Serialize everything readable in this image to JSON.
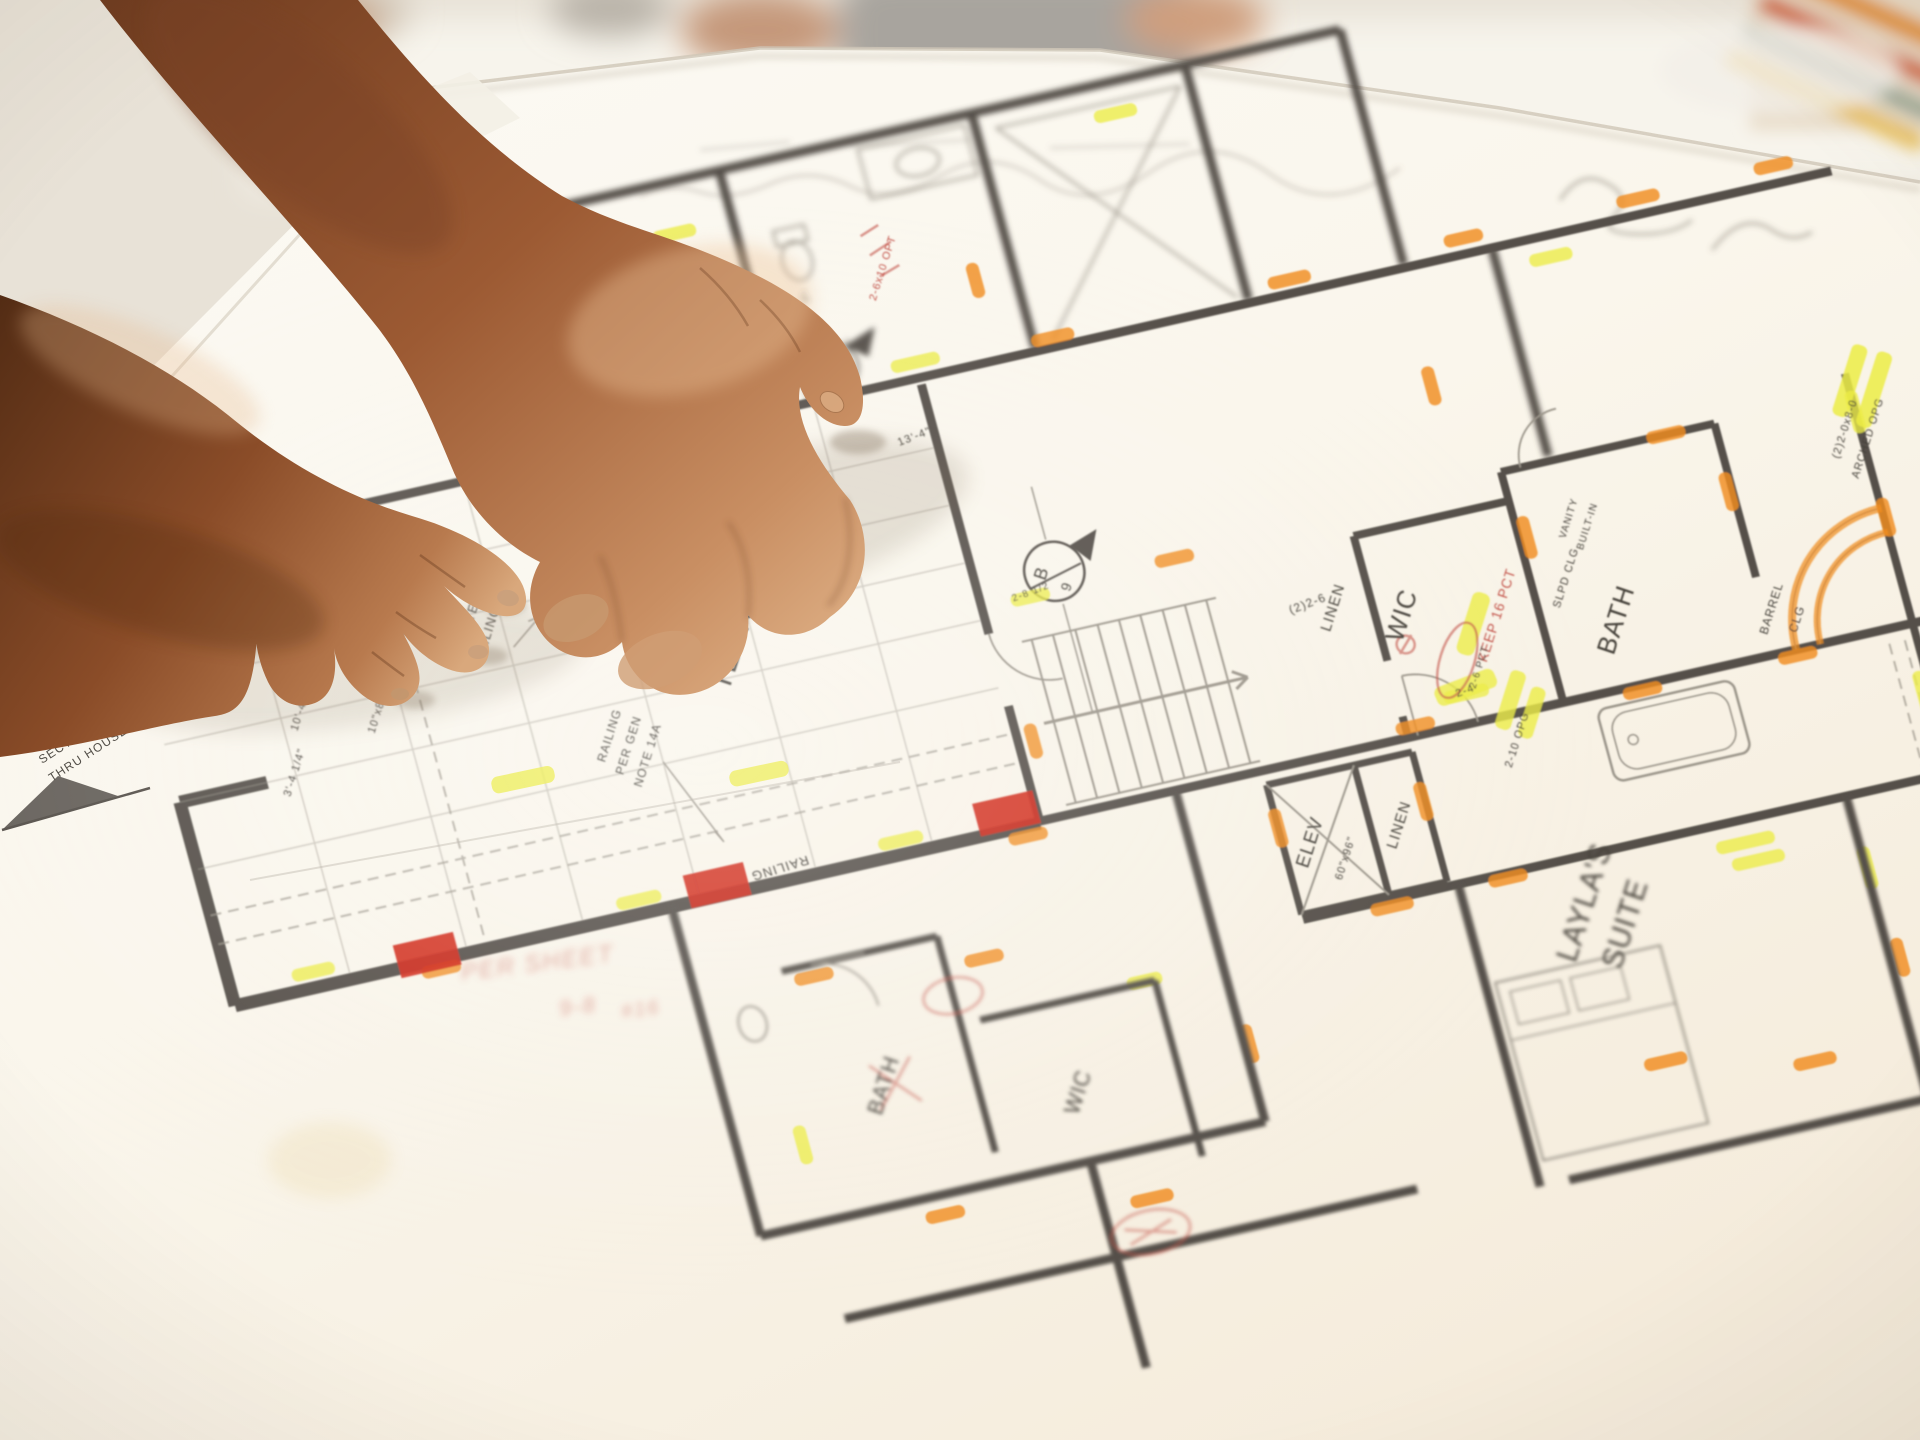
{
  "scene": {
    "description": "Two hands of a builder pointing at an architectural floor-plan blueprint laid on a table, with highlighter and red pencil markups; blurred people in background"
  },
  "colors": {
    "background": "#e8e2d7",
    "table": "#f1ebe1",
    "paper": "#fbf7ef",
    "wall": "#55504a",
    "thin_line": "#9b958a",
    "highlight_orange": "#f08c1e",
    "highlight_yellow": "#ecec45",
    "red_mark": "#d02818",
    "red_pencil": "#c4544a",
    "skin_dark": "#5f3318",
    "skin_mid": "#a5643a",
    "skin_light": "#dcab80",
    "shirt_gray": "#a8a49e",
    "stripe_orange": "#e0912f",
    "stripe_rust": "#cf5a25"
  },
  "plan": {
    "rooms": {
      "terrace_line1": "COV'D",
      "terrace_line2": "TERRACE",
      "wic_main": "WIC",
      "wic_lower": "WIC",
      "linen_upper": "LINEN",
      "linen_lower": "LINEN",
      "elev": "ELEV",
      "elev_size": "60\"x96\"",
      "bath_right": "BATH",
      "bath_lower": "BATH",
      "layla_line1": "LAYLA'S",
      "layla_line2": "SUITE"
    },
    "annotations": {
      "railing": "RAILING",
      "railing_note_1": "RAILING",
      "railing_note_2": "PER GEN",
      "railing_note_3": "NOTE 14A",
      "vaulted_1": "VAULTED",
      "vaulted_2": "CEILING",
      "wood_beam": "10\"x8\"D WOOD BEAM",
      "align": "ALIGN",
      "barrel_1": "BARREL",
      "barrel_2": "CLG",
      "sloped_clg": "SLPD CLG",
      "arched_1": "(2)2-0x8-0",
      "arched_2": "ARCHED OPG",
      "vanity_1": "VANITY",
      "vanity_2": "BUILT-IN",
      "keep_note": "KEEP 16 PCT",
      "pct_note": "2-6 PCT",
      "opt_note": "2-6x10 OPT",
      "section_line1": "SECTION",
      "section_line2": "THRU HOUSE",
      "sheet_note_1": "PER SHEET",
      "sheet_note_2": "9-8",
      "sheet_note_3": "#16"
    },
    "dimensions": {
      "d1": "10'-6 1/2\"",
      "d2": "10'-4 1/4\"",
      "d3": "3'-4 1/4\"",
      "d4": "(2)2-6",
      "d5": "2-4",
      "d6": "2-10 OPG",
      "d7": "13'-4\"",
      "d8": "5'-2\"",
      "d9": "2-8 1/2"
    },
    "markers": {
      "section_letter": "B",
      "section_number": "9"
    },
    "highlight_marks": [
      [
        120,
        168,
        46,
        "h",
        "o"
      ],
      [
        340,
        166,
        40,
        "h",
        "o"
      ],
      [
        560,
        162,
        50,
        "h",
        "y"
      ],
      [
        700,
        168,
        44,
        "h",
        "o"
      ],
      [
        945,
        164,
        44,
        "h",
        "o"
      ],
      [
        1125,
        162,
        40,
        "h",
        "o"
      ],
      [
        1305,
        162,
        44,
        "h",
        "o"
      ],
      [
        1445,
        160,
        40,
        "h",
        "o"
      ],
      [
        -185,
        626,
        44,
        "h",
        "y"
      ],
      [
        -60,
        652,
        40,
        "h",
        "o"
      ],
      [
        150,
        628,
        46,
        "h",
        "y"
      ],
      [
        420,
        628,
        46,
        "h",
        "y"
      ],
      [
        545,
        652,
        40,
        "h",
        "o"
      ],
      [
        610,
        418,
        40,
        "h",
        "y"
      ],
      [
        760,
        412,
        40,
        "h",
        "o"
      ],
      [
        950,
        630,
        40,
        "h",
        "o"
      ],
      [
        1008,
        610,
        46,
        "h",
        "y"
      ],
      [
        790,
        700,
        40,
        "v",
        "o"
      ],
      [
        938,
        706,
        40,
        "v",
        "o"
      ],
      [
        880,
        802,
        44,
        "h",
        "o"
      ],
      [
        1108,
        470,
        44,
        "v",
        "o"
      ],
      [
        1316,
        470,
        40,
        "v",
        "o"
      ],
      [
        1180,
        646,
        40,
        "h",
        "o"
      ],
      [
        1340,
        646,
        40,
        "h",
        "o"
      ],
      [
        1460,
        420,
        44,
        "v",
        "y"
      ],
      [
        1462,
        530,
        40,
        "v",
        "o"
      ],
      [
        1452,
        710,
        44,
        "v",
        "y"
      ],
      [
        1448,
        810,
        40,
        "v",
        "o"
      ],
      [
        1270,
        400,
        40,
        "h",
        "o"
      ],
      [
        1240,
        818,
        60,
        "h",
        "y"
      ],
      [
        1248,
        838,
        54,
        "h",
        "y"
      ],
      [
        1352,
        870,
        44,
        "v",
        "y"
      ],
      [
        1360,
        965,
        40,
        "v",
        "o"
      ],
      [
        1105,
        1015,
        44,
        "h",
        "o"
      ],
      [
        1250,
        1048,
        44,
        "h",
        "o"
      ],
      [
        1000,
        800,
        40,
        "h",
        "o"
      ],
      [
        300,
        742,
        40,
        "h",
        "o"
      ],
      [
        470,
        762,
        40,
        "h",
        "o"
      ],
      [
        365,
        1005,
        40,
        "h",
        "o"
      ],
      [
        570,
        1035,
        44,
        "h",
        "o"
      ],
      [
        705,
        905,
        40,
        "v",
        "o"
      ],
      [
        245,
        905,
        40,
        "v",
        "y"
      ],
      [
        620,
        820,
        36,
        "h",
        "y"
      ],
      [
        360,
        -18,
        44,
        "h",
        "y"
      ],
      [
        820,
        -38,
        44,
        "h",
        "y"
      ],
      [
        255,
        60,
        40,
        "v",
        "o"
      ],
      [
        1055,
        300,
        40,
        "v",
        "o"
      ],
      [
        1205,
        200,
        44,
        "h",
        "y"
      ],
      [
        640,
        95,
        36,
        "v",
        "o"
      ],
      [
        575,
        560,
        36,
        "v",
        "o"
      ]
    ],
    "red_patches": [
      [
        -70,
        618
      ],
      [
        230,
        614
      ],
      [
        530,
        608
      ]
    ]
  }
}
